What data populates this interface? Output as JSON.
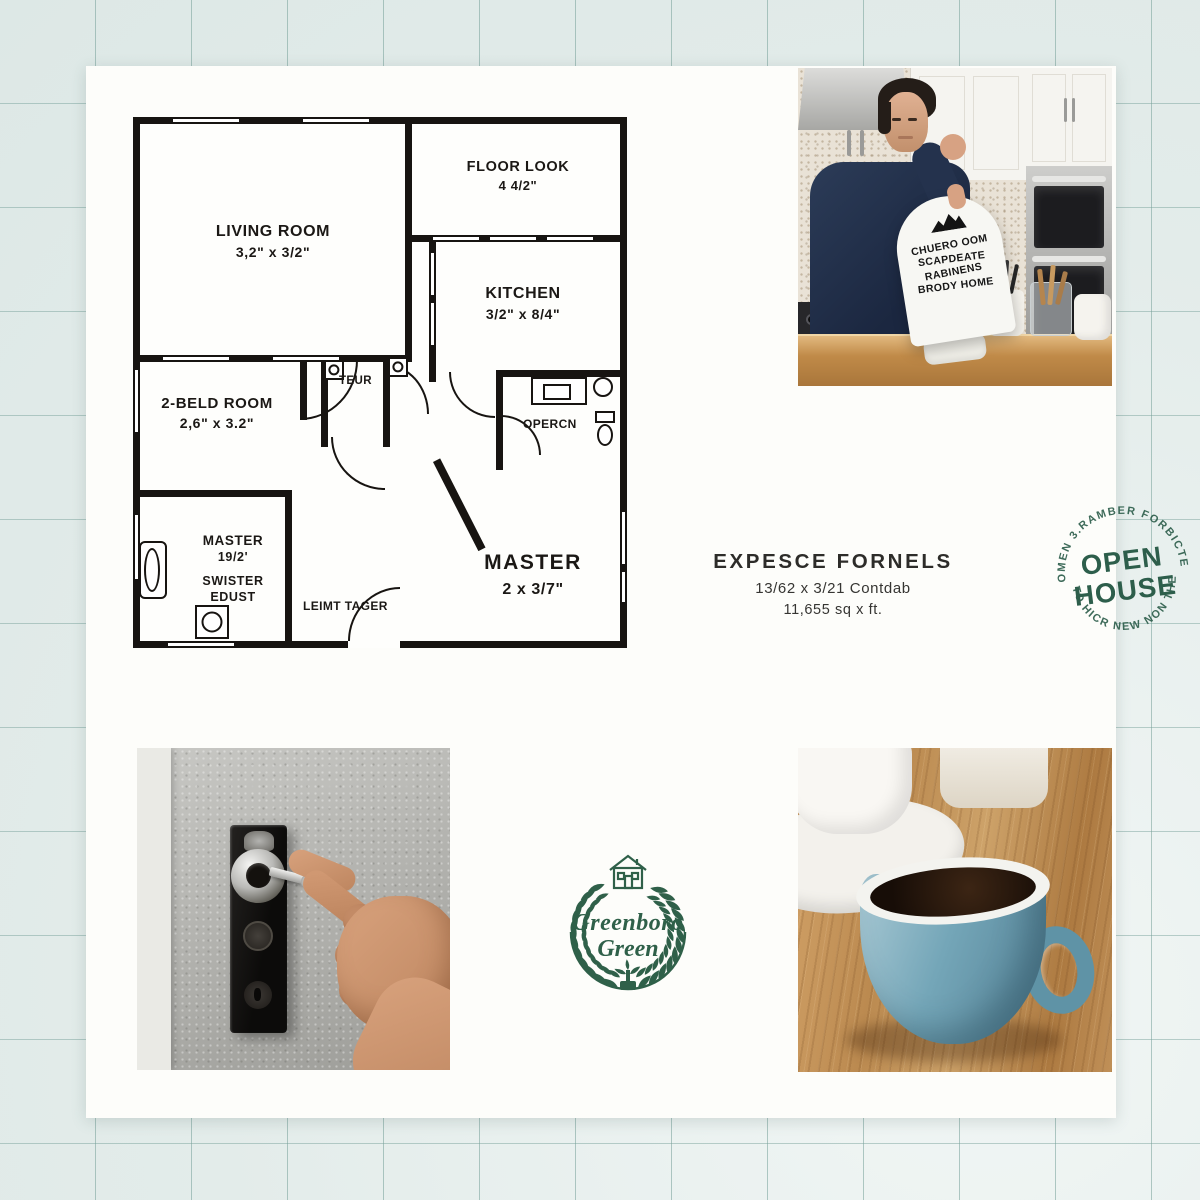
{
  "colors": {
    "stamp_green": "#2d5e4b",
    "logo_green": "#2f6049",
    "plan_ink": "#1b1815",
    "grid_line": "#76a099",
    "card": "#fdfdfa"
  },
  "floor_plan": {
    "living_room": {
      "name": "LIVING ROOM",
      "dims": "3,2\" x 3/2\""
    },
    "floor_look": {
      "name": "FLOOR LOOK",
      "dims": "4 4/2\""
    },
    "kitchen": {
      "name": "KITCHEN",
      "dims": "3/2\" x 8/4\""
    },
    "bed_room": {
      "name": "2-BELD ROOM",
      "dims": "2,6\" x 3.2\""
    },
    "teur": "TEUR",
    "opercn": "OPERCN",
    "master_bath": {
      "name": "MASTER",
      "dims": "19/2'"
    },
    "swister": {
      "line1": "SWISTER",
      "line2": "EDUST"
    },
    "master": {
      "name": "MASTER",
      "dims": "2 x 3/7\""
    },
    "leimt": "LEIMT TAGER"
  },
  "open_house_sign": {
    "lines": [
      "CHUERO OOM",
      "SCAPDEATE",
      "RABINENS",
      "BRODY HOME"
    ]
  },
  "stamp": {
    "arc_top": "OMEN 3.RAMBER FORBICTE",
    "word1": "OPEN",
    "word2": "HOUSE",
    "arc_bottom": "TO HICR NEW NON THE"
  },
  "listing": {
    "title": "EXPESCE FORNELS",
    "dims": "13/62 x 3/21 Contdab",
    "area": "11,655 sq x ft."
  },
  "logo": {
    "line1": "Greenboro",
    "line2": "Green"
  }
}
